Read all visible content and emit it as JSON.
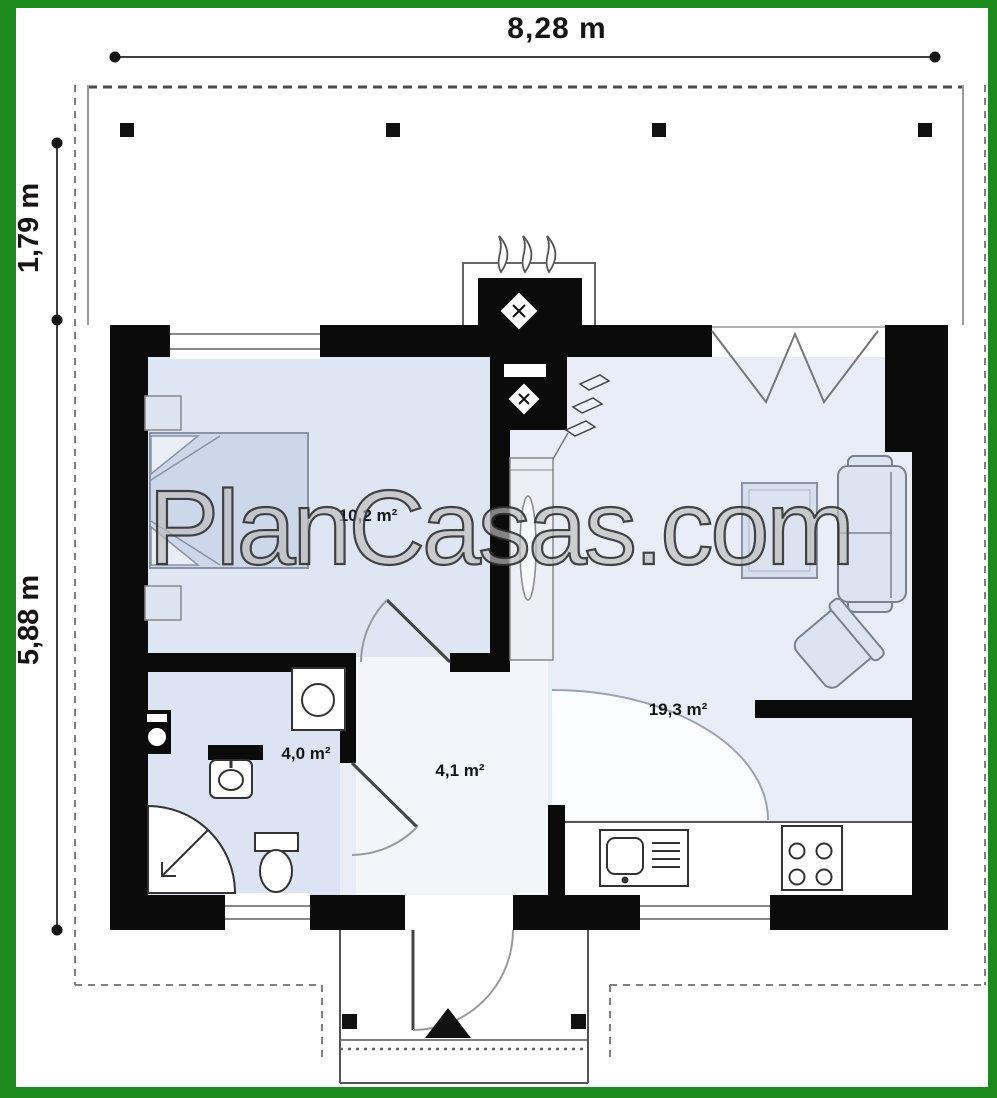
{
  "plan": {
    "watermark": "PlanCasas.com",
    "dimensions": {
      "overall_width": "8,28 m",
      "terrace_depth": "1,79 m",
      "house_depth": "5,88 m"
    },
    "rooms": {
      "bedroom": {
        "area": "10,2 m²"
      },
      "bathroom": {
        "area": "4,0 m²"
      },
      "hall": {
        "area": "4,1 m²"
      },
      "living_kitchen": {
        "area": "19,3 m²"
      }
    },
    "colors": {
      "frame_green": "#1c8a1c",
      "wall_black": "#0b0b0b",
      "floor_blue": "#dfe6f3",
      "floor_light": "#e9edf7"
    }
  }
}
